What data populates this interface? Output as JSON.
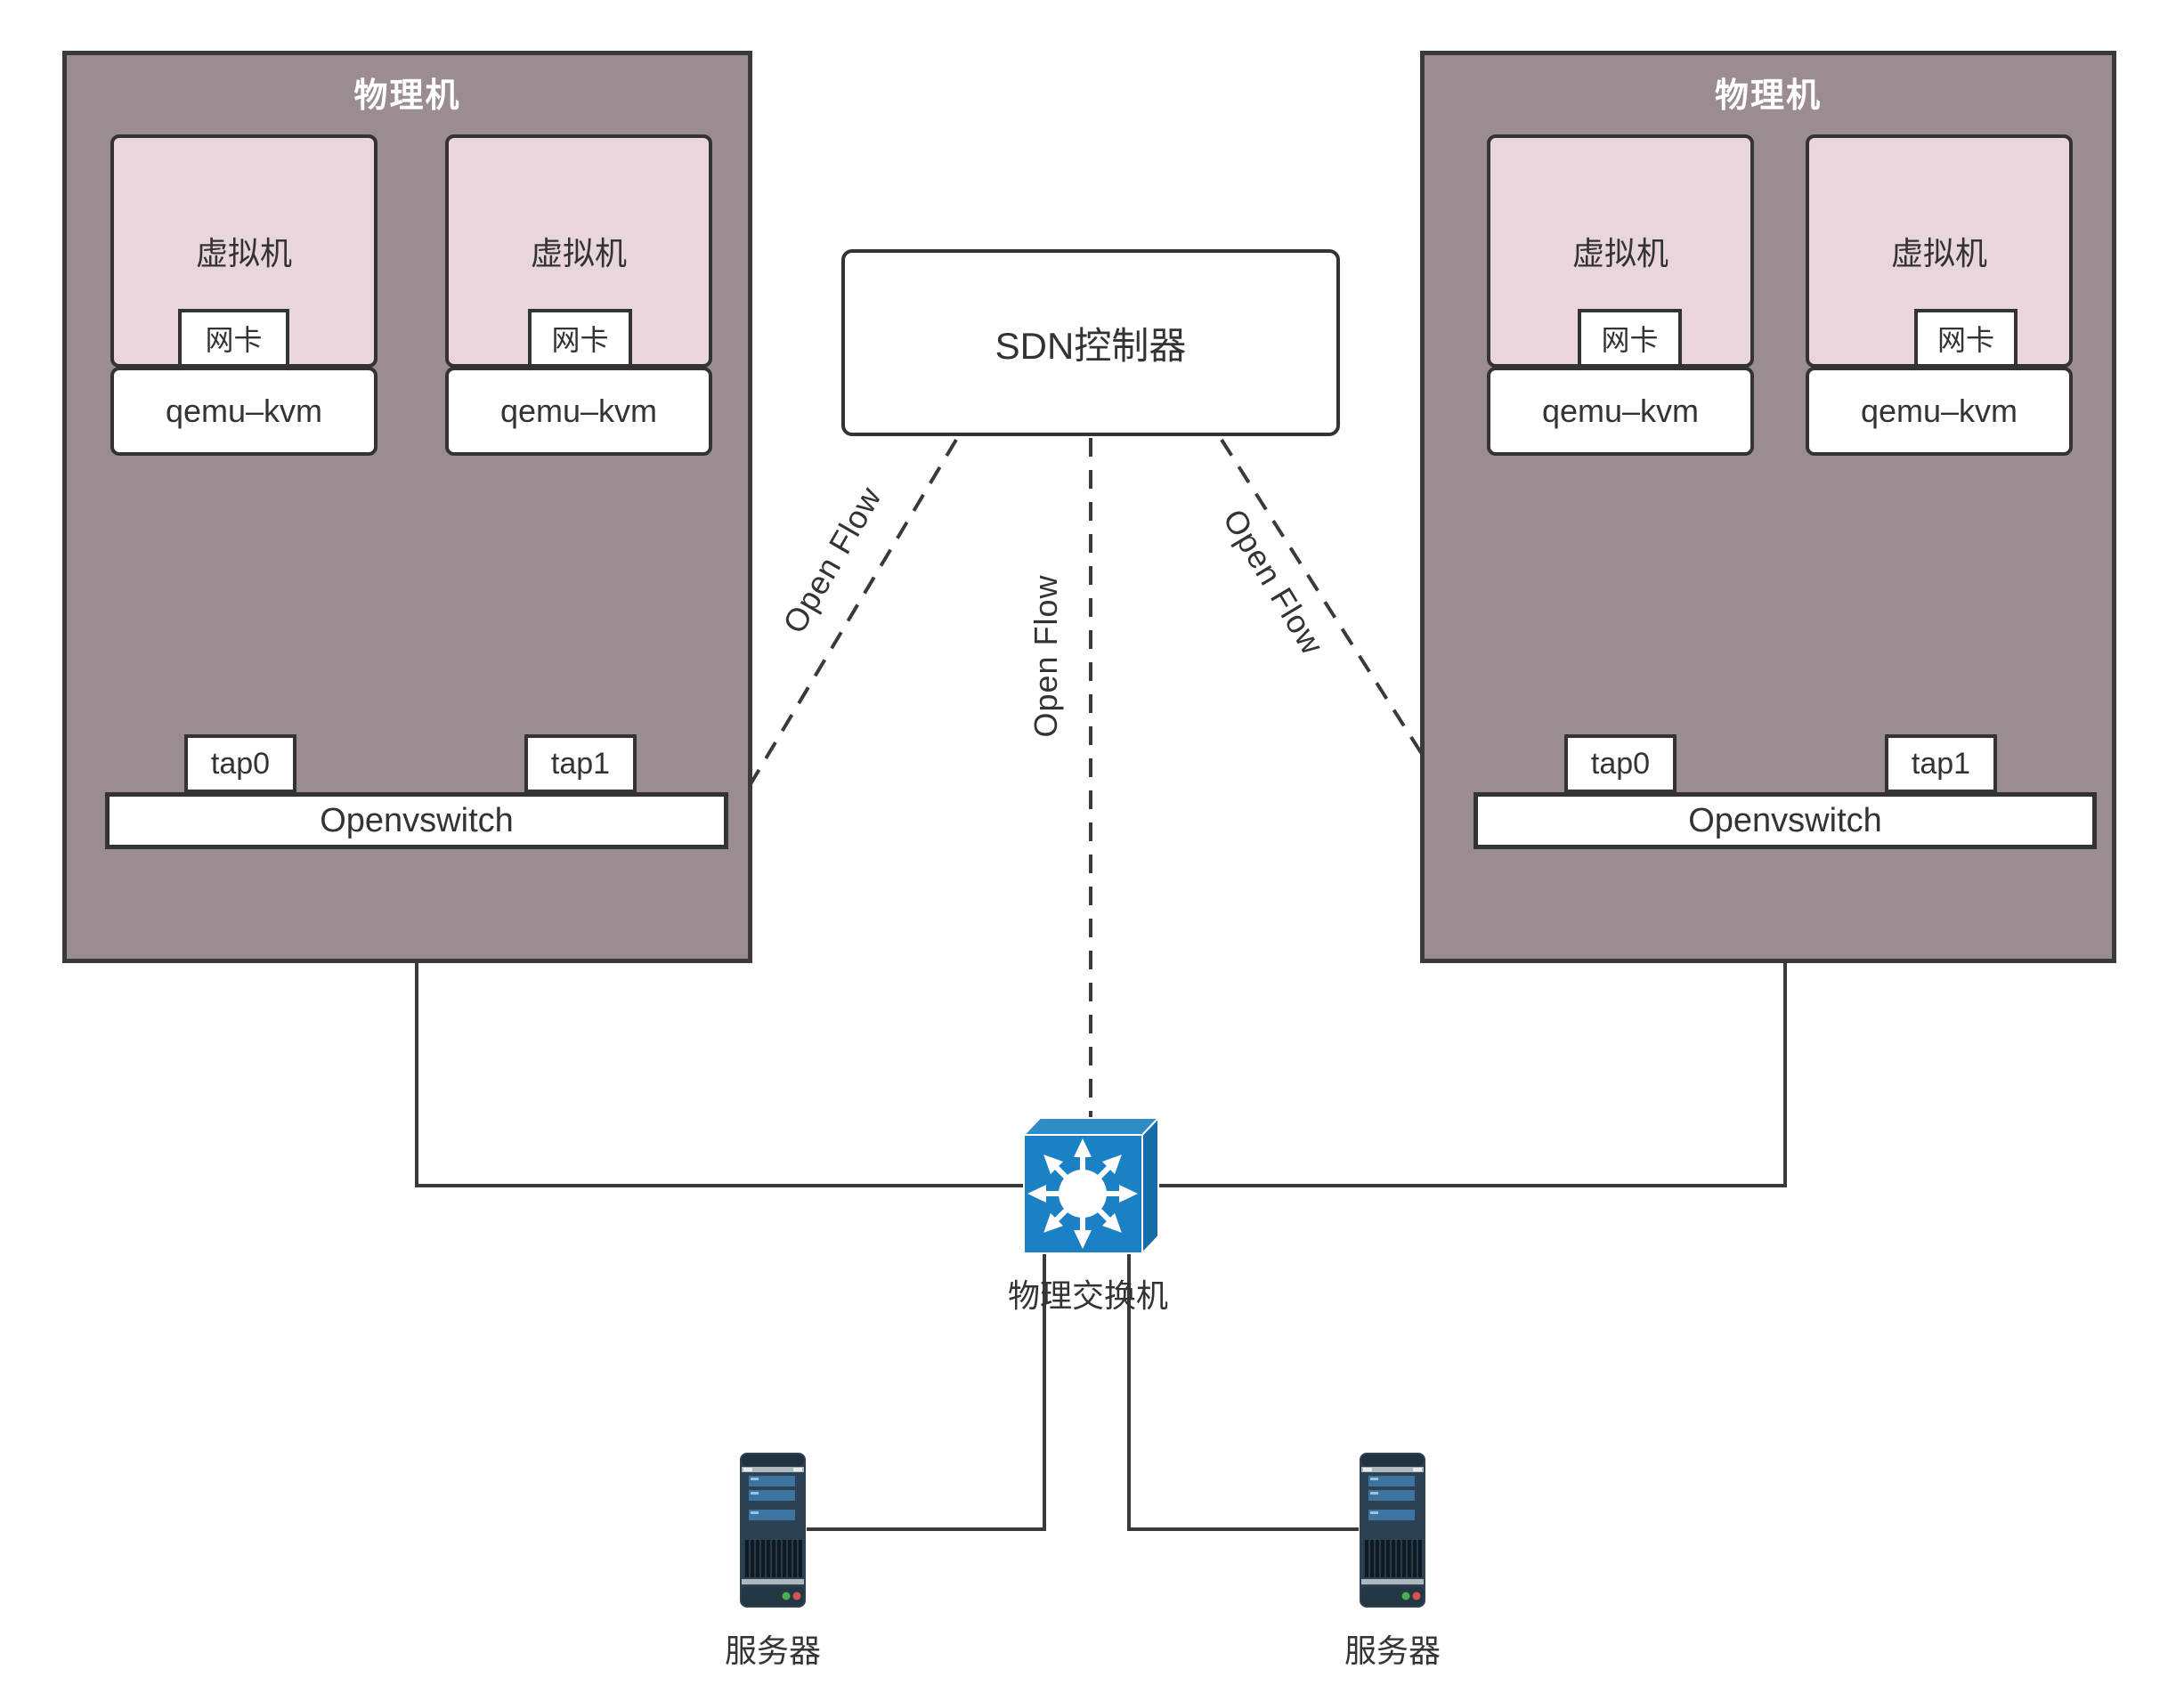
{
  "hosts": [
    {
      "title": "物理机",
      "vms": [
        {
          "label": "虚拟机",
          "nic": "网卡"
        },
        {
          "label": "虚拟机",
          "nic": "网卡"
        }
      ],
      "hypervisors": [
        "qemu–kvm",
        "qemu–kvm"
      ],
      "taps": [
        "tap0",
        "tap1"
      ],
      "vswitch": "Openvswitch"
    },
    {
      "title": "物理机",
      "vms": [
        {
          "label": "虚拟机",
          "nic": "网卡"
        },
        {
          "label": "虚拟机",
          "nic": "网卡"
        }
      ],
      "hypervisors": [
        "qemu–kvm",
        "qemu–kvm"
      ],
      "taps": [
        "tap0",
        "tap1"
      ],
      "vswitch": "Openvswitch"
    }
  ],
  "controller": {
    "label": "SDN控制器"
  },
  "openflow": [
    "Open Flow",
    "Open Flow",
    "Open Flow"
  ],
  "physical_switch": {
    "label": "物理交换机"
  },
  "servers": [
    {
      "label": "服务器"
    },
    {
      "label": "服务器"
    }
  ],
  "colors": {
    "host_fill": "#9B8C92",
    "vm_fill": "#E9D5DC",
    "line": "#3A3A3A",
    "switch_front": "#1B80C4",
    "switch_top": "#2E8CC9",
    "switch_side": "#156CA9",
    "server_body": "#2C4254",
    "server_bar": "#3D74A0",
    "led_green": "#4CAF50",
    "led_red": "#D9534F"
  }
}
